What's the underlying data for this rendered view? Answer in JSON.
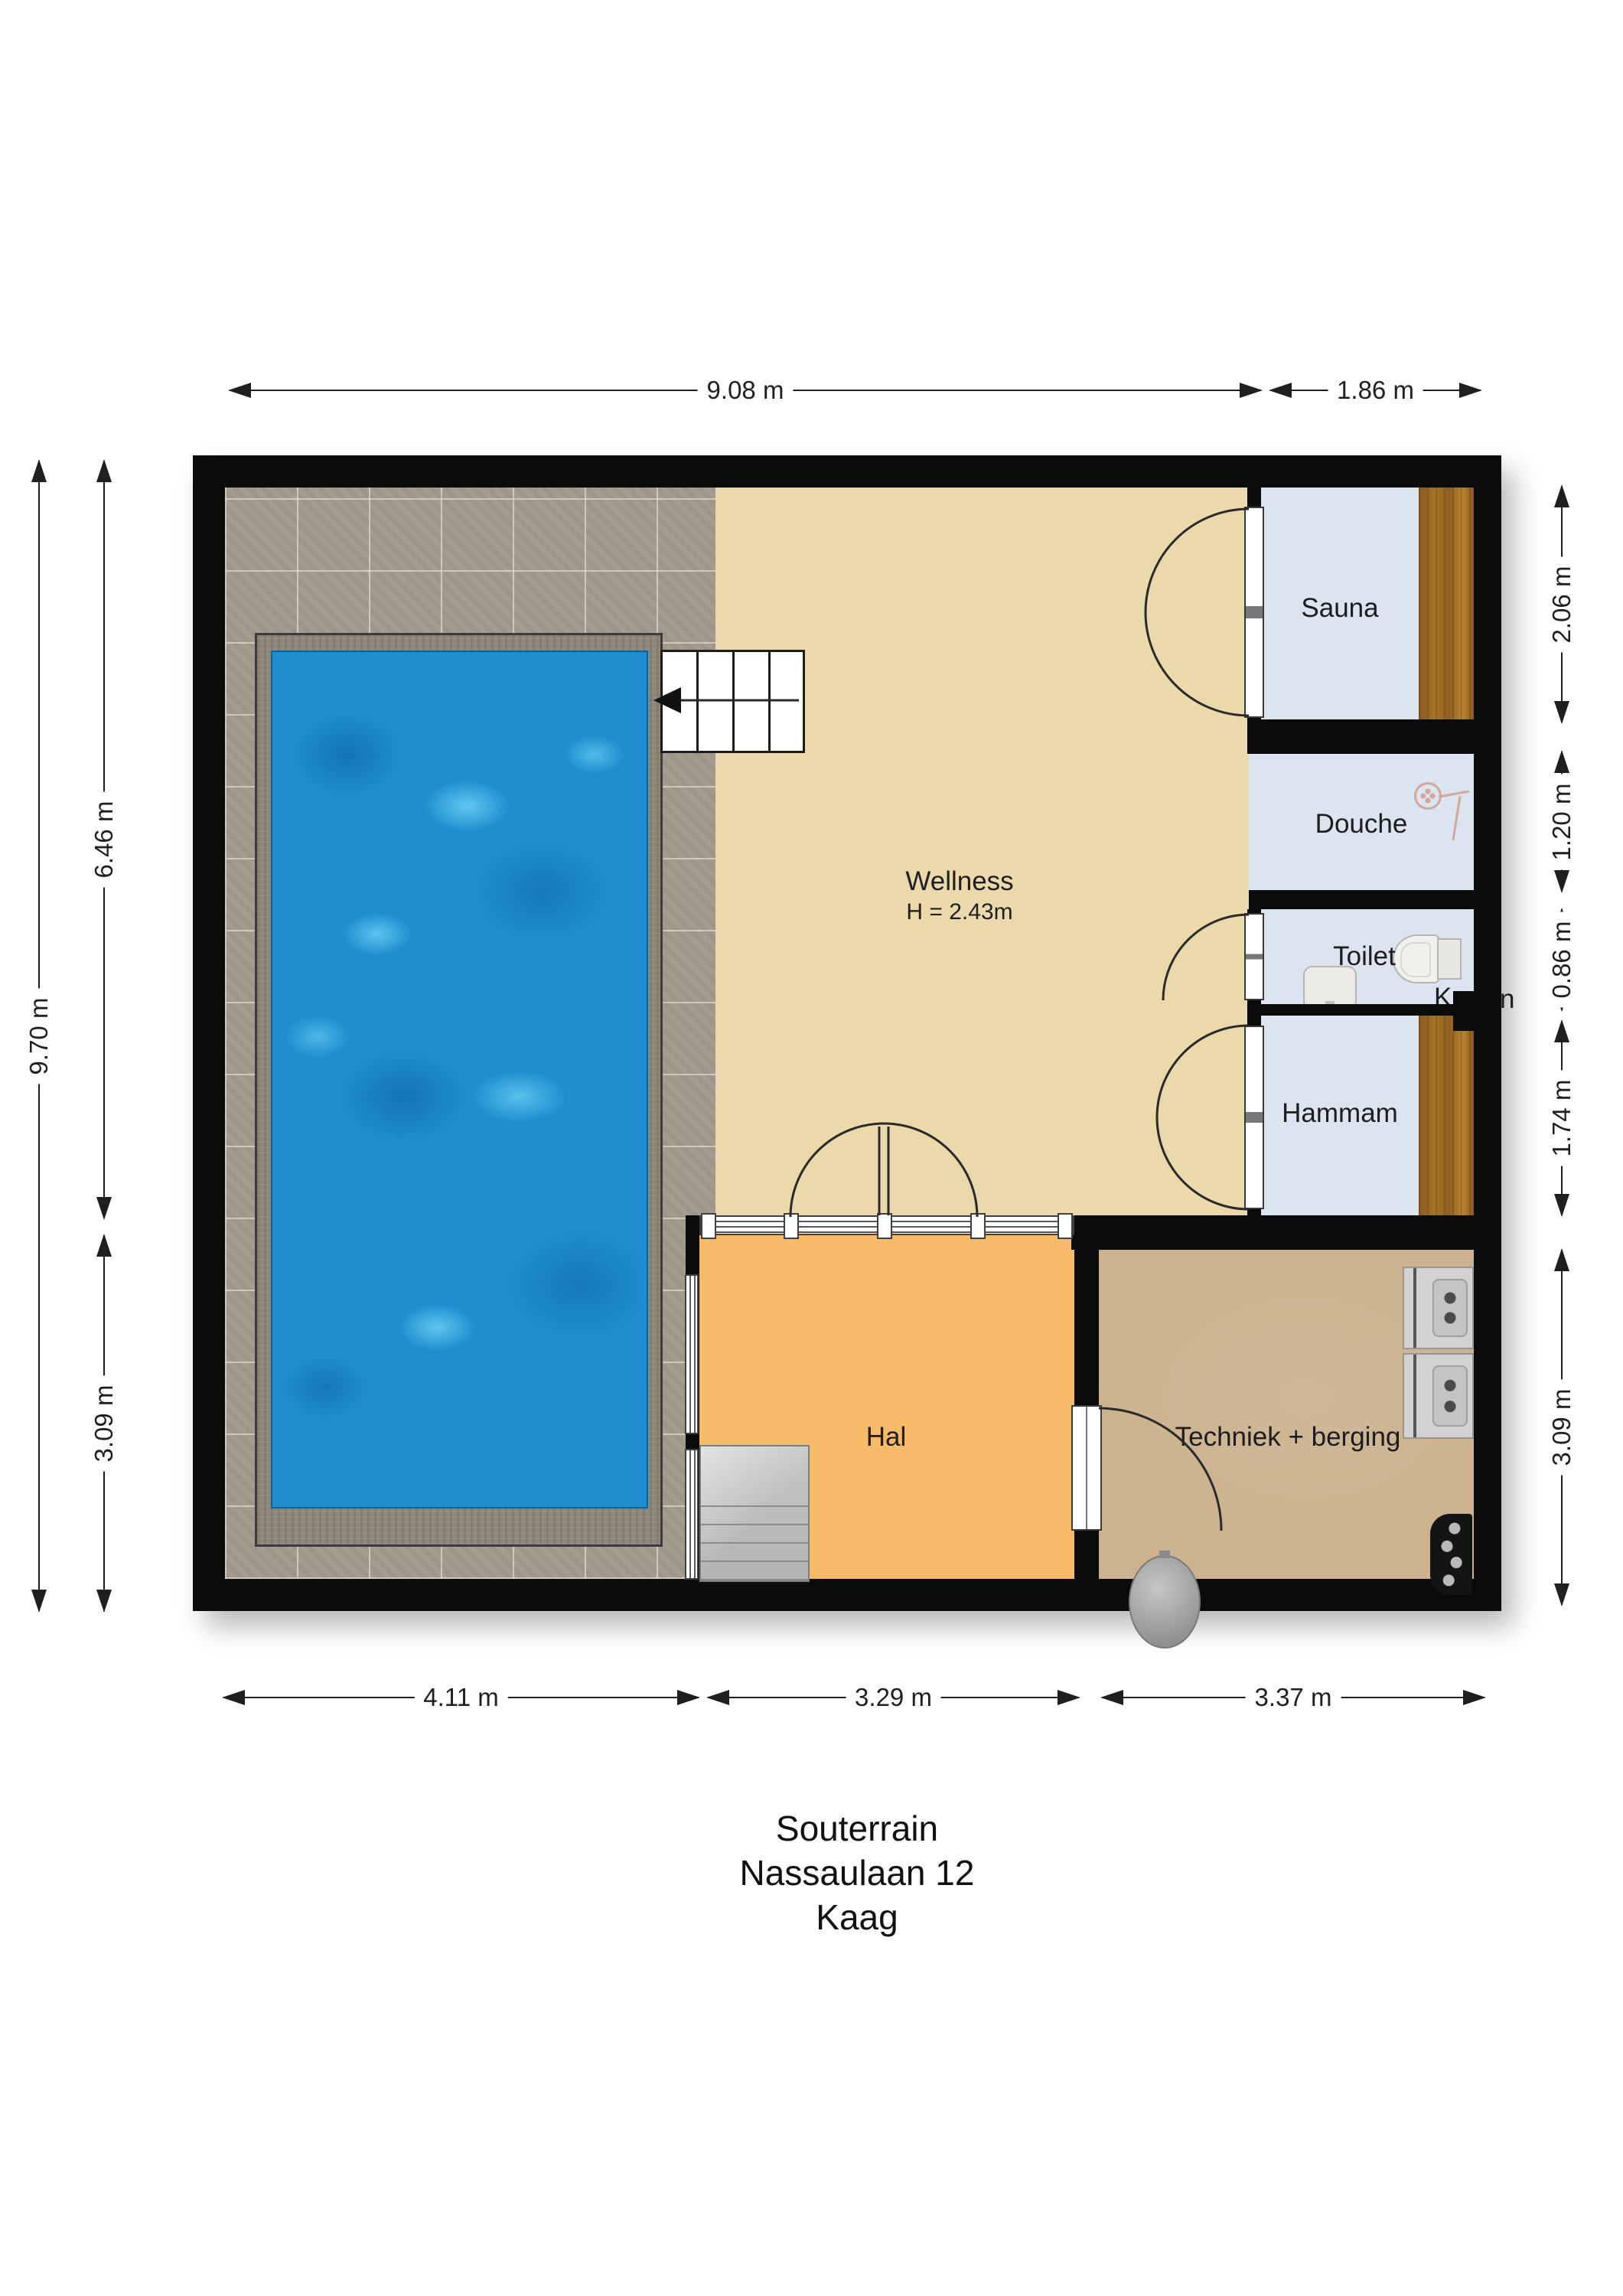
{
  "document": {
    "type": "floor-plan",
    "floor_name": "Souterrain"
  },
  "title": {
    "lines": [
      "Souterrain",
      "Nassaulaan 12",
      "Kaag"
    ]
  },
  "rooms": {
    "wellness": {
      "label": "Wellness",
      "height_note": "H = 2.43m"
    },
    "sauna": {
      "label": "Sauna"
    },
    "douche": {
      "label": "Douche"
    },
    "toilet": {
      "label": "Toilet"
    },
    "hammam": {
      "label": "Hammam"
    },
    "hal": {
      "label": "Hal"
    },
    "techniek": {
      "label": "Techniek + berging"
    }
  },
  "obscured_label": {
    "visible_left": "K",
    "visible_right": "n"
  },
  "dims": {
    "top": [
      {
        "label": "9.08 m"
      },
      {
        "label": "1.86 m"
      }
    ],
    "left_outer": {
      "label": "9.70 m"
    },
    "left_inner": [
      {
        "label": "6.46 m"
      },
      {
        "label": "3.09 m"
      }
    ],
    "right": [
      {
        "label": "2.06 m"
      },
      {
        "label": "1.20 m"
      },
      {
        "label": "0.86 m"
      },
      {
        "label": "1.74 m"
      },
      {
        "label": "3.09 m"
      }
    ],
    "bottom": [
      {
        "label": "4.11 m"
      },
      {
        "label": "3.29 m"
      },
      {
        "label": "3.37 m"
      }
    ]
  },
  "colors": {
    "wall": "#0b0b0b",
    "wellness_floor": "#ecd9ab",
    "hal_floor": "#f6ba68",
    "techniek_floor": "#ccb28e",
    "wet_room_floor": "#dbe4ef",
    "wood_bench": "#a87428",
    "tile_floor": "#a59c90",
    "pool_water": "#1e8ecf",
    "pool_edge": "#8d8779",
    "stairs": "#bcbcbc",
    "dimension_text": "#1f1f1f"
  }
}
